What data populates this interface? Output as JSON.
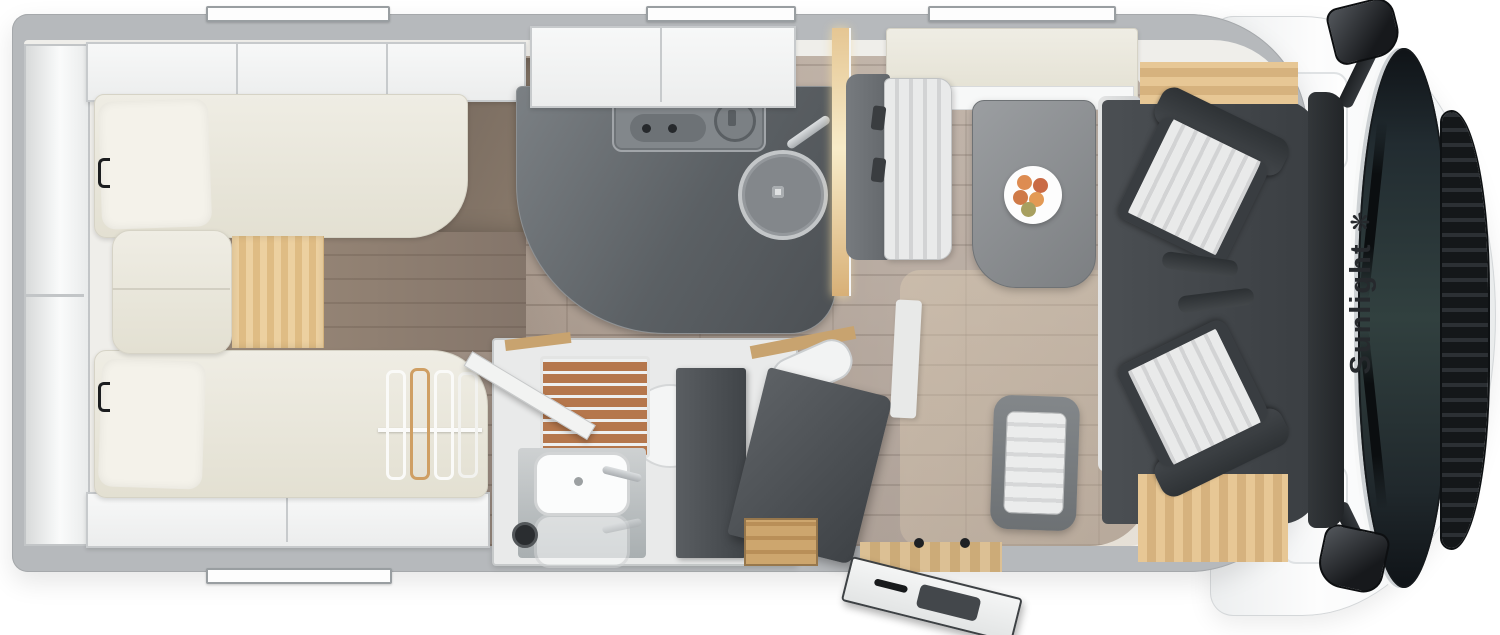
{
  "brand": {
    "logo_text": "Sunlight",
    "logo_glyph": "❋",
    "logo_icon": "sun-star-icon"
  },
  "palette": {
    "background": "#ffffff",
    "wall_gray": "#b6b9bc",
    "cab_body_white": "#fbfcfc",
    "windshield_dark": "#1c2125",
    "grille_dark": "#16191c",
    "interior_white": "#efeeea",
    "floor_wood": "#ab9c8f",
    "floor_walnut_dark": "#6b6057",
    "oak_accent": "#e2c294",
    "bed_cream": "#ece9dd",
    "counter_dark": "#53575b",
    "seat_gray": "#6e7276",
    "cushion_stripe_light": "#e9eaea",
    "cushion_stripe_dark": "#d2d3d4",
    "cab_seat_dark": "#34383b",
    "shower_teak": "#b5774c",
    "table_gray": "#8a8d90",
    "fruit_colors": [
      "#dd8c52",
      "#cf7a48",
      "#e39a55",
      "#c96a45",
      "#e8a65c",
      "#a8a060"
    ]
  }
}
